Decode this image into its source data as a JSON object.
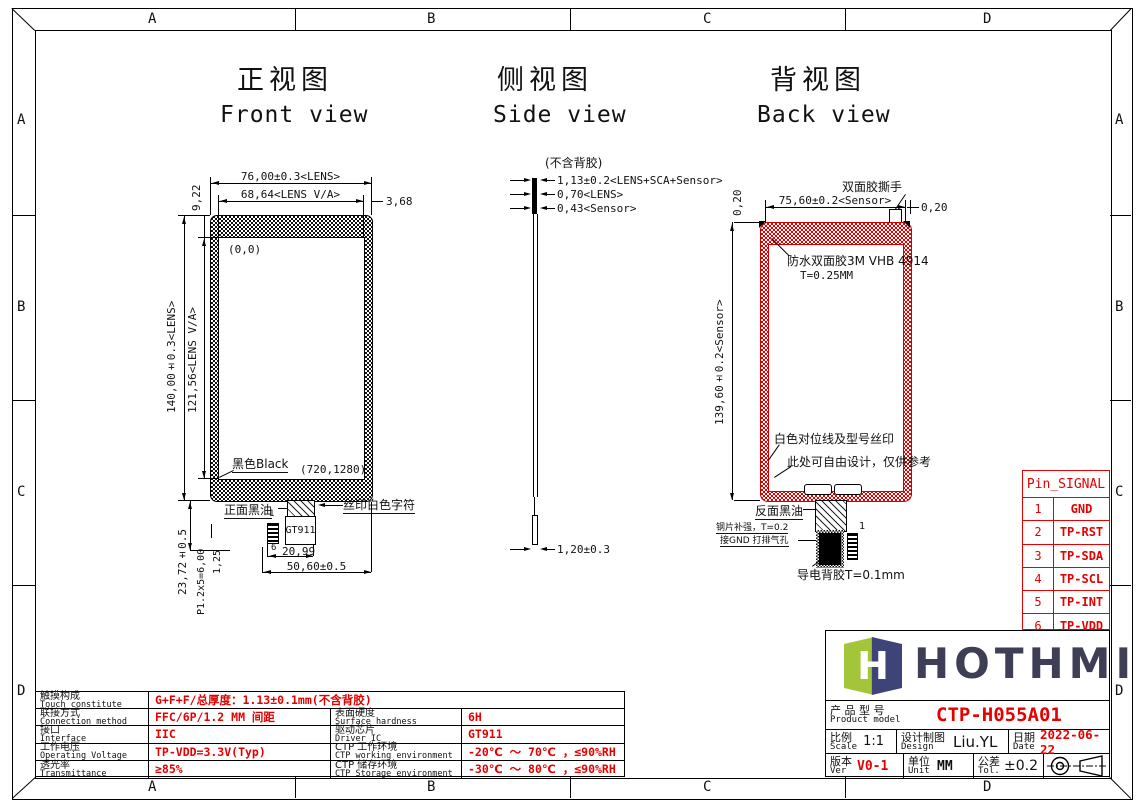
{
  "frame": {
    "cols": [
      "A",
      "B",
      "C",
      "D"
    ],
    "rows": [
      "A",
      "B",
      "C",
      "D"
    ]
  },
  "titles": {
    "front_zh": "正视图",
    "front_en": "Front view",
    "side_zh": "侧视图",
    "side_en": "Side view",
    "back_zh": "背视图",
    "back_en": "Back view"
  },
  "front": {
    "dim_width": "76,00±0.3<LENS>",
    "dim_va_width": "68,64<LENS V/A>",
    "dim_side_margin": "3,68",
    "dim_top_margin": "9,22",
    "origin": "(0,0)",
    "dim_height": "140,00±0.3<LENS>",
    "dim_va_height": "121,56<LENS V/A>",
    "label_bezel": "黑色Black",
    "resolution": "(720,1280)",
    "label_front_ink": "正面黑油",
    "label_silkscreen": "丝印白色字符",
    "driver_ic": "GT911",
    "pin_first": "1",
    "pin_last": "6",
    "dim_ic_offset": "20,99",
    "dim_tail_width": "50,60±0.5",
    "dim_tail_length": "23,72±0.5",
    "dim_pin_pitch": "P1.2x5=6,00",
    "dim_pin_width": "1,25"
  },
  "side": {
    "note": "(不含背胶)",
    "dim_total": "1,13±0.2<LENS+SCA+Sensor>",
    "dim_lens": "0,70<LENS>",
    "dim_sensor": "0,43<Sensor>",
    "dim_fpc": "1,20±0.3"
  },
  "back": {
    "dim_corner_left": "0,20",
    "dim_corner_right": "0,20",
    "dim_width": "75,60±0.2<Sensor>",
    "label_tab": "双面胶撕手",
    "label_tape_line1": "防水双面胶3M VHB 4914",
    "label_tape_line2": "T=0.25MM",
    "dim_height": "139,60±0.2<Sensor>",
    "label_white_marks": "白色对位线及型号丝印",
    "label_free_design": "此处可自由设计，仅供参考",
    "label_back_ink": "反面黑油",
    "label_steel_line1": "钢片补强，T=0.2",
    "label_steel_line2": "接GND 打排气孔",
    "pin_first": "1",
    "label_conductive": "导电背胶T=0.1mm"
  },
  "pin_table": {
    "title": "Pin_SIGNAL",
    "rows": [
      [
        "1",
        "GND"
      ],
      [
        "2",
        "TP-RST"
      ],
      [
        "3",
        "TP-SDA"
      ],
      [
        "4",
        "TP-SCL"
      ],
      [
        "5",
        "TP-INT"
      ],
      [
        "6",
        "TP-VDD"
      ]
    ]
  },
  "spec_table": {
    "rows": [
      {
        "zh": "触摸构成",
        "en": "Touch constitute",
        "value": "G+F+F/总厚度：1.13±0.1mm(不含背胶)"
      },
      {
        "zh": "联接方式",
        "en": "Connection method",
        "value": "FFC/6P/1.2 MM 间距",
        "zh2": "表面硬度",
        "en2": "Surface hardness",
        "value2": "6H"
      },
      {
        "zh": "接口",
        "en": "Interface",
        "value": "IIC",
        "zh2": "驱动芯片",
        "en2": "Driver IC",
        "value2": "GT911"
      },
      {
        "zh": "工作电压",
        "en": "Operating Voltage",
        "value": "TP-VDD=3.3V(Typ)",
        "zh2": "CTP 工作环境",
        "en2": "CTP working environment",
        "value2": "-20℃ ～ 70℃ ，≤90%RH"
      },
      {
        "zh": "透光率",
        "en": "Transmittance",
        "value": "≥85%",
        "zh2": "CTP 储存环境",
        "en2": "CTP Storage environment",
        "value2": "-30℃ ～ 80℃ ，≤90%RH"
      }
    ]
  },
  "title_block": {
    "brand": "HOTHMI",
    "logo_letter": "H",
    "product_label_zh": "产 品 型 号",
    "product_label_en": "Product model",
    "product_model": "CTP-H055A01",
    "scale_zh": "比例",
    "scale_en": "Scale",
    "scale": "1:1",
    "design_zh": "设计制图",
    "design_en": "Design",
    "designer": "Liu.YL",
    "date_zh": "日期",
    "date_en": "Date",
    "date": "2022-06-22",
    "ver_zh": "版本",
    "ver_en": "Ver",
    "version": "V0-1",
    "unit_zh": "单位",
    "unit_en": "Unit",
    "unit": "MM",
    "tol_zh": "公差",
    "tol_en": "Tol.",
    "tolerance": "±0.2"
  },
  "colors": {
    "red": "#e60000",
    "logo_green": "#a3c53a",
    "logo_navy": "#3f4478"
  }
}
